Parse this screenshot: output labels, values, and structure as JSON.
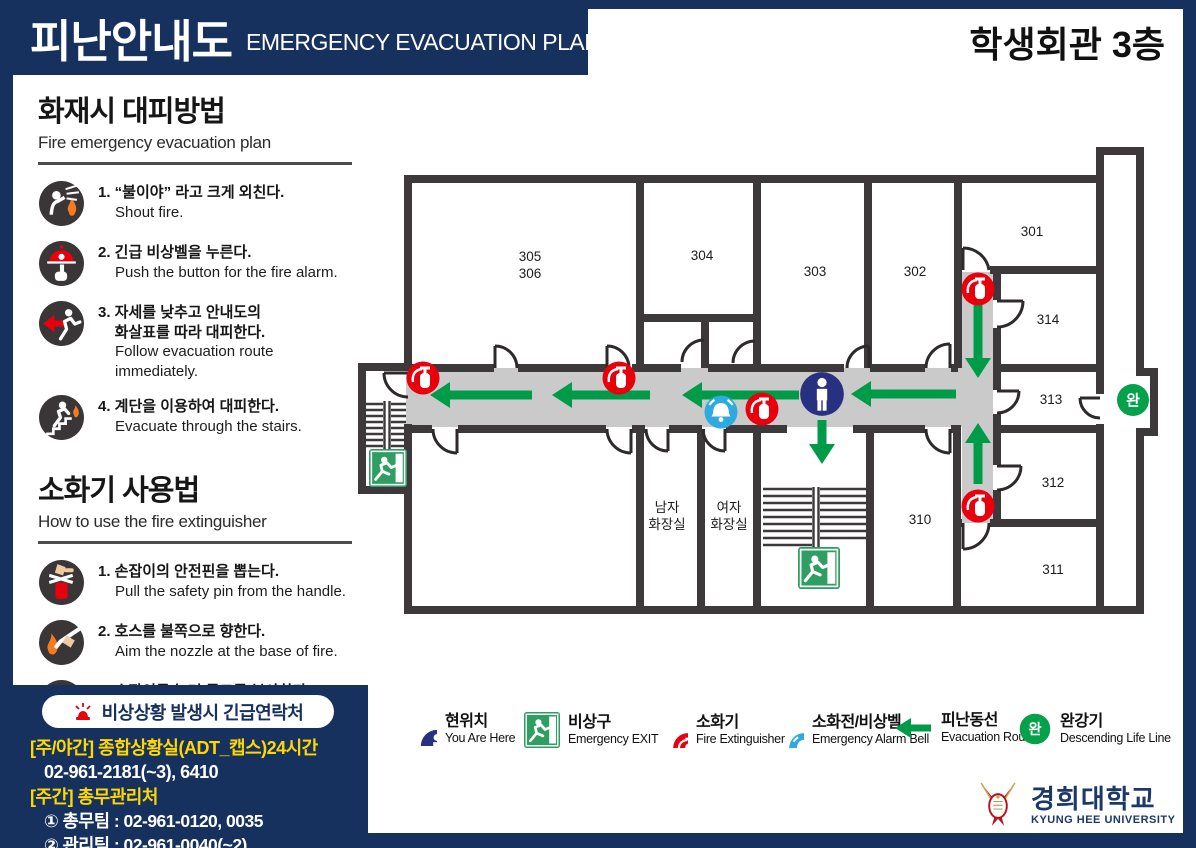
{
  "page": {
    "title_kr": "피난안내도",
    "title_en": "EMERGENCY EVACUATION PLAN",
    "building": "학생회관 3층"
  },
  "colors": {
    "navy_bg": "#17315f",
    "wall": "#3d393a",
    "corridor": "#cbcaca",
    "route_green": "#009b48",
    "alert_red": "#e8000d",
    "bell_blue": "#2eaae1",
    "here_navy": "#283180",
    "exit_green": "#2f9e62",
    "contact_yellow": "#ffd800"
  },
  "evacuation_guide": {
    "title": "화재시 대피방법",
    "subtitle": "Fire emergency evacuation plan",
    "steps": [
      {
        "kr": "1. “불이야” 라고 크게 외친다.",
        "en": "Shout fire."
      },
      {
        "kr": "2. 긴급 비상벨을 누른다.",
        "en": "Push the button for the fire alarm."
      },
      {
        "kr": "3. 자세를 낮추고 안내도의\n    화살표를 따라 대피한다.",
        "en": "Follow evacuation route immediately."
      },
      {
        "kr": "4. 계단을 이용하여 대피한다.",
        "en": "Evacuate through the stairs."
      }
    ]
  },
  "extinguisher_guide": {
    "title": "소화기 사용법",
    "subtitle": "How to use the fire extinguisher",
    "steps": [
      {
        "kr": "1. 손잡이의 안전핀을 뽑는다.",
        "en": "Pull the safety pin from the handle."
      },
      {
        "kr": "2. 호스를 불쪽으로 향한다.",
        "en": "Aim the nozzle at the base of fire."
      },
      {
        "kr": "3. 손잡이를 눌러 골고루 분사한다.",
        "en": "Squeeze the handle and\nsweep the nozzle from side to side."
      }
    ]
  },
  "contact": {
    "heading": "비상상황 발생시 긴급연락처",
    "line1_label": "[주/야간] 종합상황실(ADT_캡스)24시간",
    "line1_value": "02-961-2181(~3), 6410",
    "line2_label": "[주간] 총무관리처",
    "items": [
      "① 총무팀 : 02-961-0120, 0035",
      "② 관리팀 : 02-961-0040(~2)",
      "③ 안전팀 : 02-961-0119"
    ]
  },
  "floorplan": {
    "rooms": {
      "r305": "305",
      "r306": "306",
      "r304": "304",
      "r303": "303",
      "r302": "302",
      "r301": "301",
      "r314": "314",
      "r313": "313",
      "r312": "312",
      "r311": "311",
      "r310": "310",
      "toilet_m_l1": "남자",
      "toilet_m_l2": "화장실",
      "toilet_f_l1": "여자",
      "toilet_f_l2": "화장실",
      "life_line_badge": "완"
    }
  },
  "legend": {
    "items": [
      {
        "kr": "현위치",
        "en": "You Are Here",
        "icon": "you-are-here-icon"
      },
      {
        "kr": "비상구",
        "en": "Emergency EXIT",
        "icon": "emergency-exit-icon"
      },
      {
        "kr": "소화기",
        "en": "Fire Extinguisher",
        "icon": "fire-extinguisher-icon"
      },
      {
        "kr": "소화전/비상벨",
        "en": "Emergency Alarm Bell",
        "icon": "alarm-bell-icon"
      },
      {
        "kr": "피난동선",
        "en": "Evacuation Route",
        "icon": "route-arrow-icon"
      },
      {
        "kr": "완강기",
        "en": "Descending Life Line",
        "icon": "life-line-icon",
        "badge": "완"
      }
    ]
  },
  "footer_logo": {
    "kr": "경희대학교",
    "en": "KYUNG HEE UNIVERSITY"
  }
}
